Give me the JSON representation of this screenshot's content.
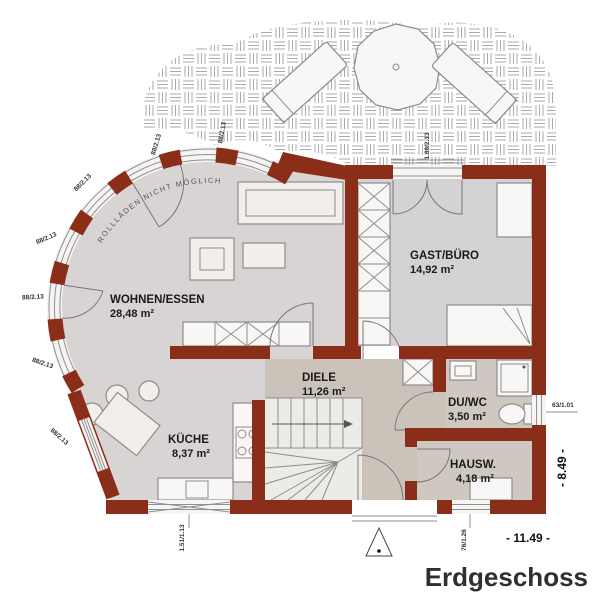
{
  "title": "Erdgeschoss",
  "note_curved_wall": "ROLLLÄDEN NICHT MÖGLICH",
  "rooms": {
    "wohnen": {
      "name": "WOHNEN/ESSEN",
      "area": "28,48 m²"
    },
    "gast": {
      "name": "GAST/BÜRO",
      "area": "14,92 m²"
    },
    "diele": {
      "name": "DIELE",
      "area": "11,26 m²"
    },
    "duwc": {
      "name": "DU/WC",
      "area": "3,50 m²"
    },
    "kueche": {
      "name": "KÜCHE",
      "area": "8,37 m²"
    },
    "hausw": {
      "name": "HAUSW.",
      "area": "4,18 m²"
    }
  },
  "dimensions": {
    "width_label": "- 11.49 -",
    "height_label": "- 8.49 -"
  },
  "windows": {
    "curve": [
      "88/2.13",
      "88/2.13",
      "88/2.13",
      "88/2.13",
      "88/2.13",
      "88/2.13",
      "88/2.13"
    ],
    "terrace_door": "1.88/2.13",
    "kitchen": "1.51/1.13",
    "wc": "63/1.01",
    "hausw": "76/1.26"
  },
  "colors": {
    "wall": "#8a2e1a",
    "floor_main": "#d8d4d3",
    "floor_gast": "#d5d2d5",
    "floor_diele": "#cbc3ba",
    "floor_beige": "#cfc8c0",
    "floor_stairs": "#edebe8",
    "furniture": "#f1eeeb",
    "line": "#8c8c8c",
    "hatch": "#a9a9a9",
    "text": "#1a1a1a",
    "title": "#2f2f2f"
  }
}
